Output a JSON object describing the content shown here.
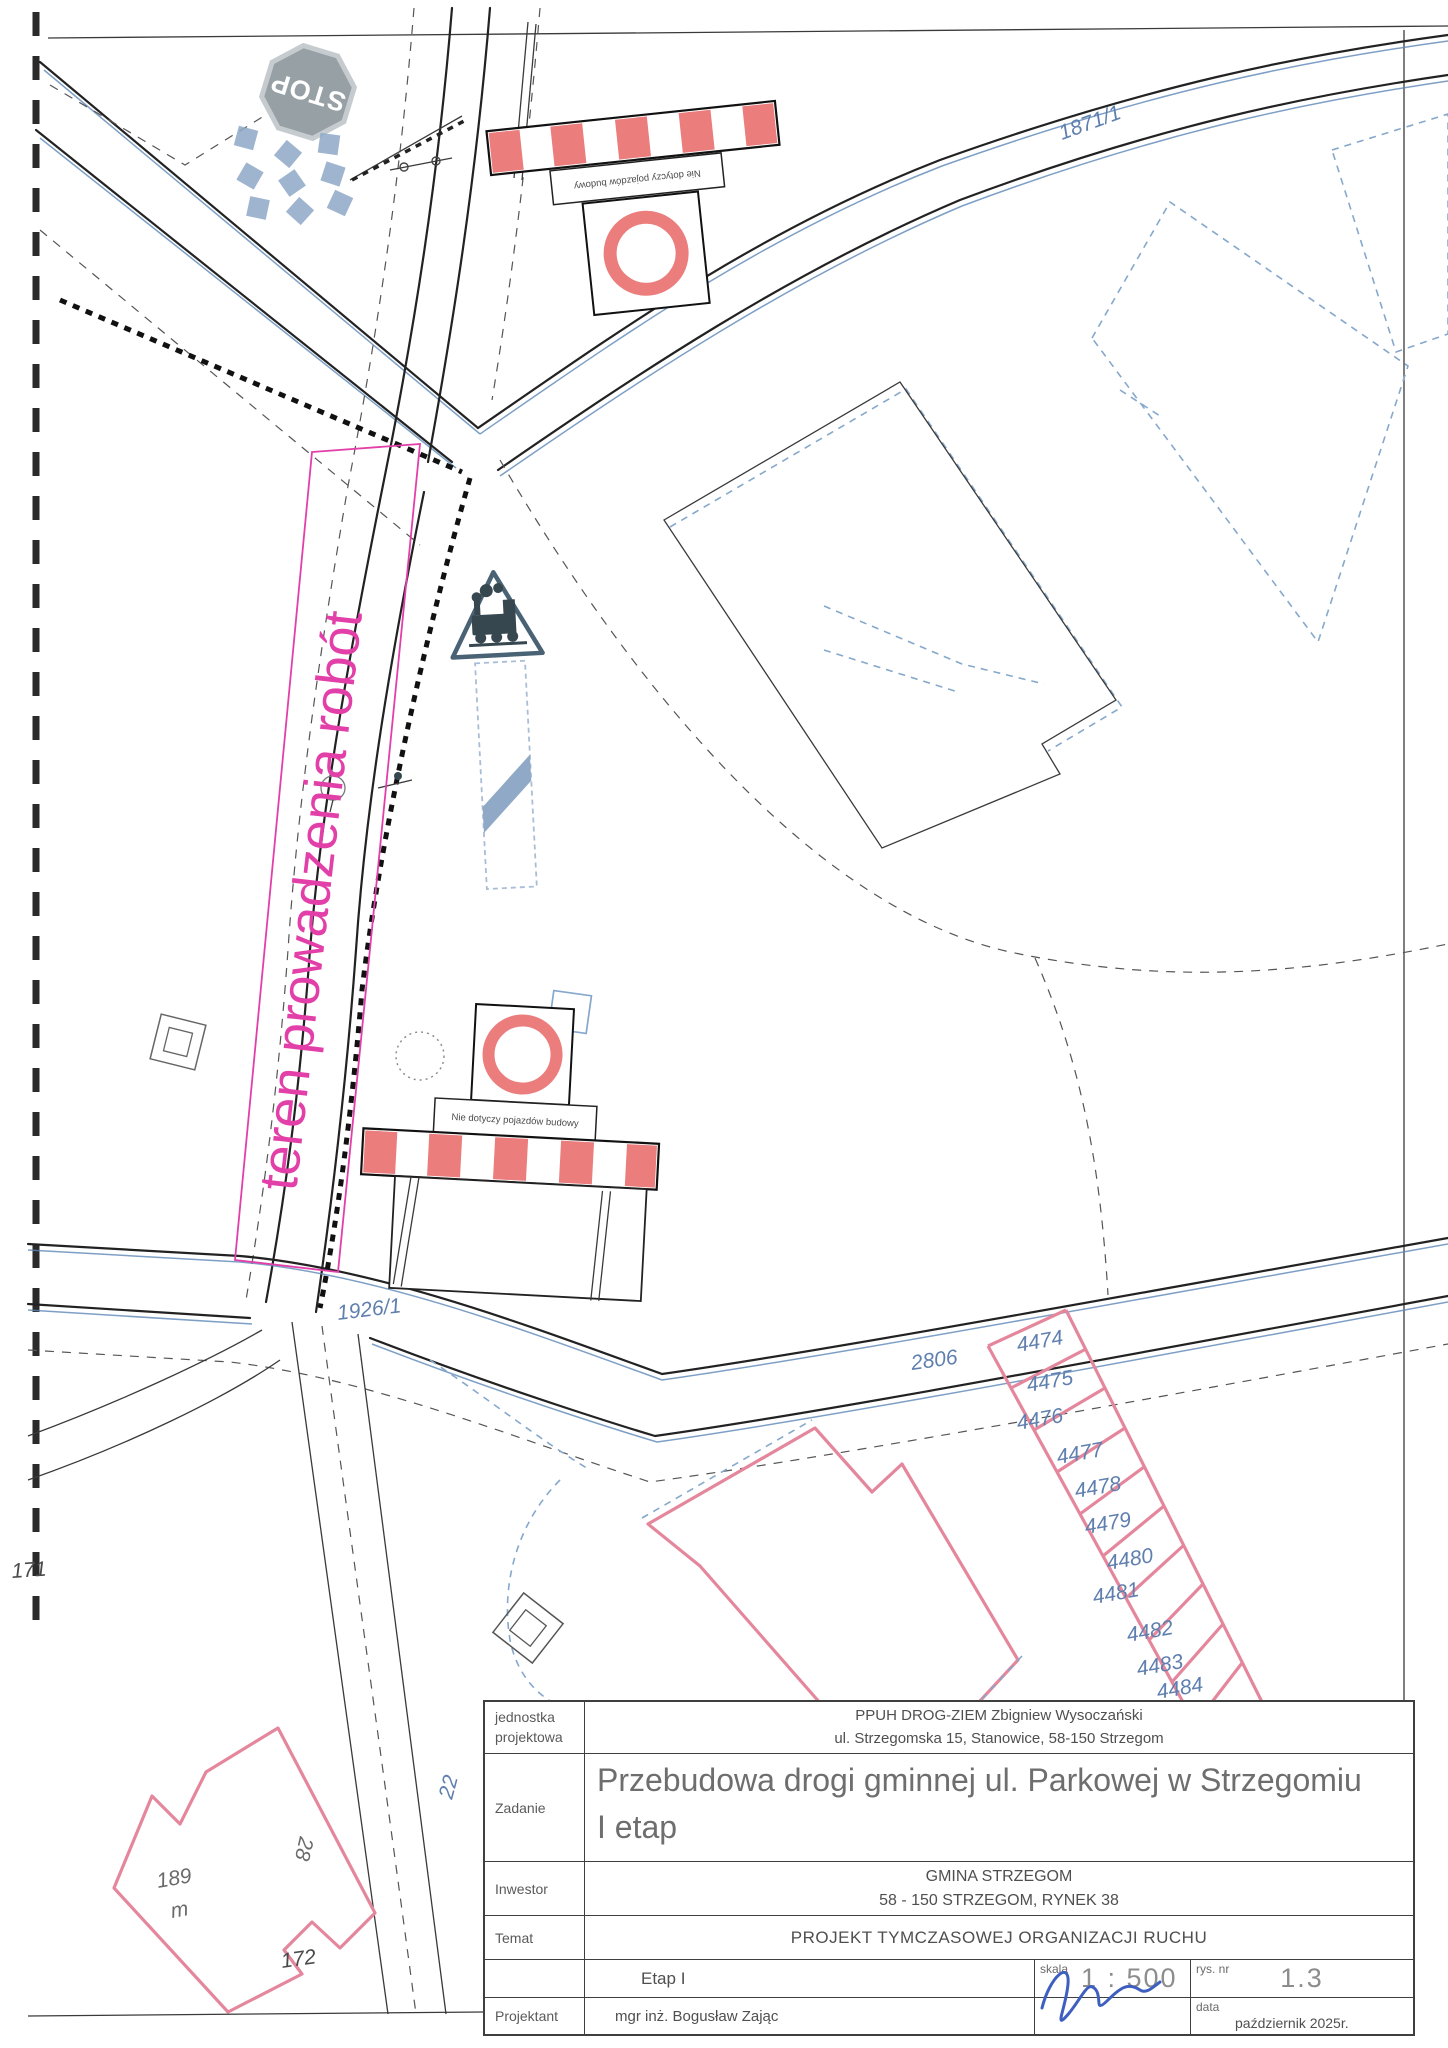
{
  "colors": {
    "magenta": "#e23fa9",
    "pink": "#e5879c",
    "sign-red": "#ec7d7d",
    "blue-line": "#5d87b8",
    "blue-dash": "#86a8cc",
    "blue-label": "#5f7fae",
    "steel": "#8fa9c7",
    "gray-sign": "#97a0a5",
    "signature-blue": "#3f5fc0"
  },
  "map": {
    "work_zone_label": "teren prowadzenia robót",
    "stop_sign": "STOP",
    "barrier_note": "Nie dotyczy pojazdów budowy",
    "parcels": {
      "road_upper": "1871/1",
      "road_lower": "1926/1",
      "big": "2806",
      "left_edge": "171",
      "near_table": "22",
      "house_number": "189",
      "house_suffix": "m",
      "house_side": "28",
      "house_parcel": "172",
      "strip": [
        "4474",
        "4475",
        "4476",
        "4477",
        "4478",
        "4479",
        "4480",
        "4481",
        "4482",
        "4483",
        "4484"
      ]
    }
  },
  "titleblock": {
    "design_unit": {
      "label_line1": "jednostka",
      "label_line2": "projektowa",
      "name": "PPUH DROG-ZIEM Zbigniew Wysoczański",
      "address": "ul. Strzegomska 15, Stanowice, 58-150 Strzegom"
    },
    "task": {
      "label": "Zadanie",
      "line1": "Przebudowa drogi gminnej ul. Parkowej w Strzegomiu",
      "line2": "I etap"
    },
    "investor": {
      "label": "Inwestor",
      "name": "GMINA STRZEGOM",
      "address": "58 - 150 STRZEGOM, RYNEK 38"
    },
    "subject": {
      "label": "Temat",
      "value": "PROJEKT TYMCZASOWEJ ORGANIZACJI RUCHU"
    },
    "stage": {
      "value": "Etap I"
    },
    "scale": {
      "label": "skala",
      "value": "1 : 500"
    },
    "drawing_no": {
      "label": "rys. nr",
      "value": "1.3"
    },
    "designer": {
      "label": "Projektant",
      "name": "mgr inż. Bogusław Zając"
    },
    "date": {
      "label": "data",
      "value": "październik 2025r."
    }
  }
}
